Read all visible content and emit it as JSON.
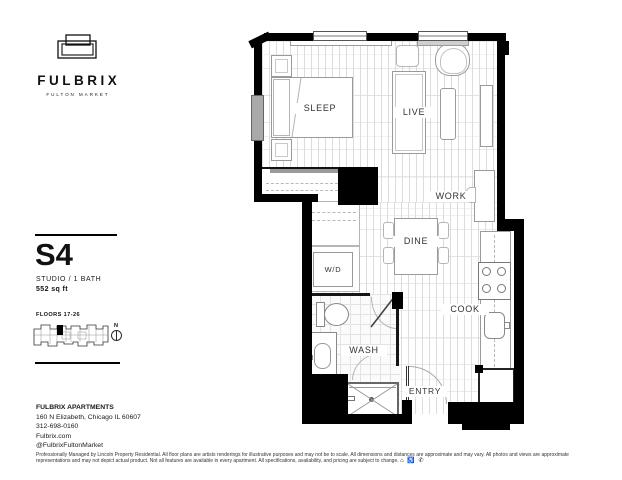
{
  "brand": {
    "name": "FULBRIX",
    "tagline": "FULTON MARKET"
  },
  "unit": {
    "code": "S4",
    "type": "STUDIO / 1 BATH",
    "area": "552 sq ft"
  },
  "floors": {
    "label": "FLOORS 17-26",
    "north_label": "N"
  },
  "contact": {
    "name": "FULBRIX APARTMENTS",
    "address": "160 N Elizabeth, Chicago IL 60607",
    "phone": "312-698-0160",
    "website": "Fulbrix.com",
    "social": "@FulbrixFultonMarket"
  },
  "disclaimer": {
    "text": "Professionally Managed by Lincoln Property Residential. All floor plans are artists renderings for illustrative purposes and may not be to scale. All dimensions and distances are approximate and may vary. All photos and views are approximate representations and may not depict actual product. Not all features are available in every apartment. All specifications, availability, and pricing are subject to change.",
    "icons": "⌂ ♿ ✆"
  },
  "plan": {
    "rooms": {
      "sleep": "SLEEP",
      "live": "LIVE",
      "work": "WORK",
      "dine": "DINE",
      "cook": "COOK",
      "wd": "W/D",
      "wash": "WASH",
      "entry": "ENTRY"
    }
  },
  "colors": {
    "wall": "#000000",
    "floor_line": "#dcdcdc",
    "fixture_line": "#9a9a9a",
    "window_gray": "#a9a9a9"
  }
}
